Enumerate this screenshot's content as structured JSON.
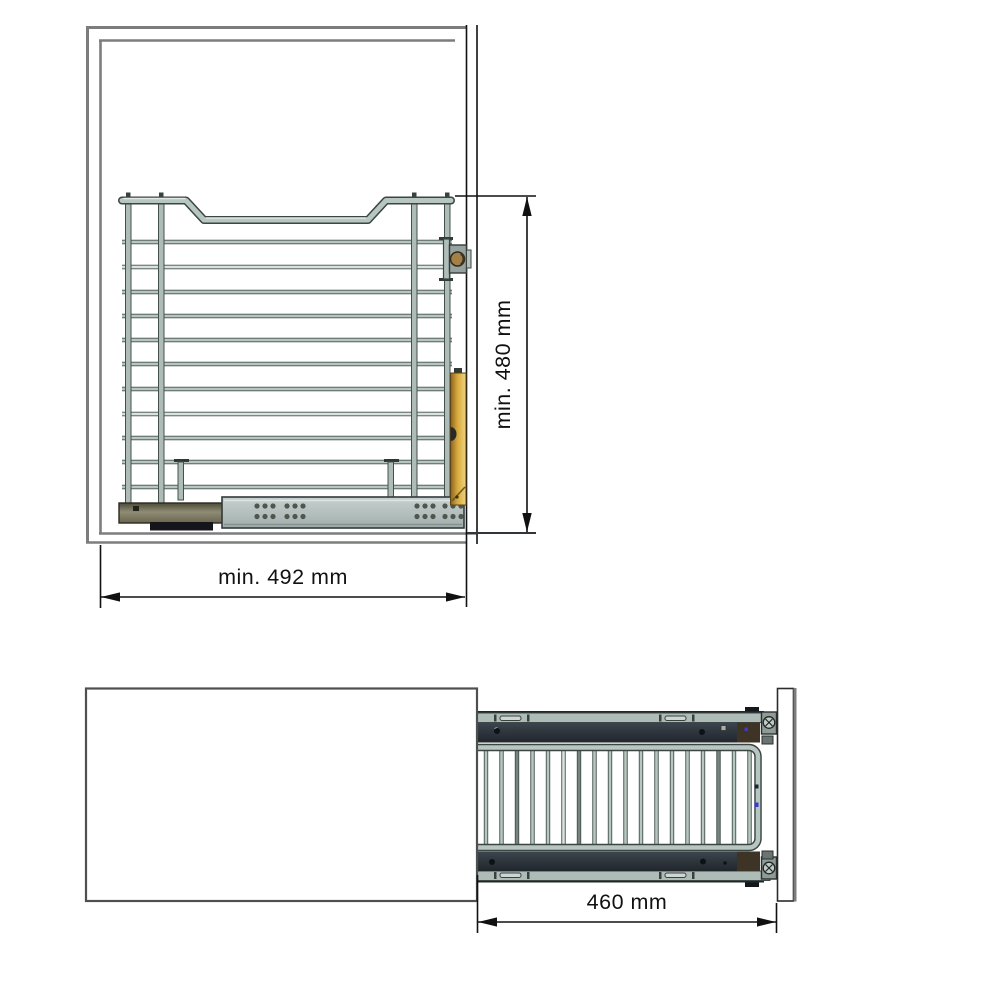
{
  "drawing": {
    "type": "technical-drawing-pullout-wire-basket",
    "views": {
      "front": {
        "name": "cabinet-front-view-with-basket",
        "label_width": "min. 492 mm",
        "label_height": "min. 480 mm"
      },
      "top": {
        "name": "extended-basket-top-view",
        "label_depth": "460 mm"
      }
    },
    "colors": {
      "cabinet_line": "#7d7d7d",
      "dimension_line": "#111111",
      "wire_light": "#b7c6c0",
      "wire_pale": "#d8e2de",
      "wire_outline": "#44504b",
      "slide_gray": "#b5c0be",
      "rail_olive": "#6f6b53",
      "bracket_orange": "#dcb14a",
      "bracket_bronze": "#a58046",
      "rail_charcoal": "#2c343b",
      "accent_blue": "#3a3acc"
    }
  }
}
